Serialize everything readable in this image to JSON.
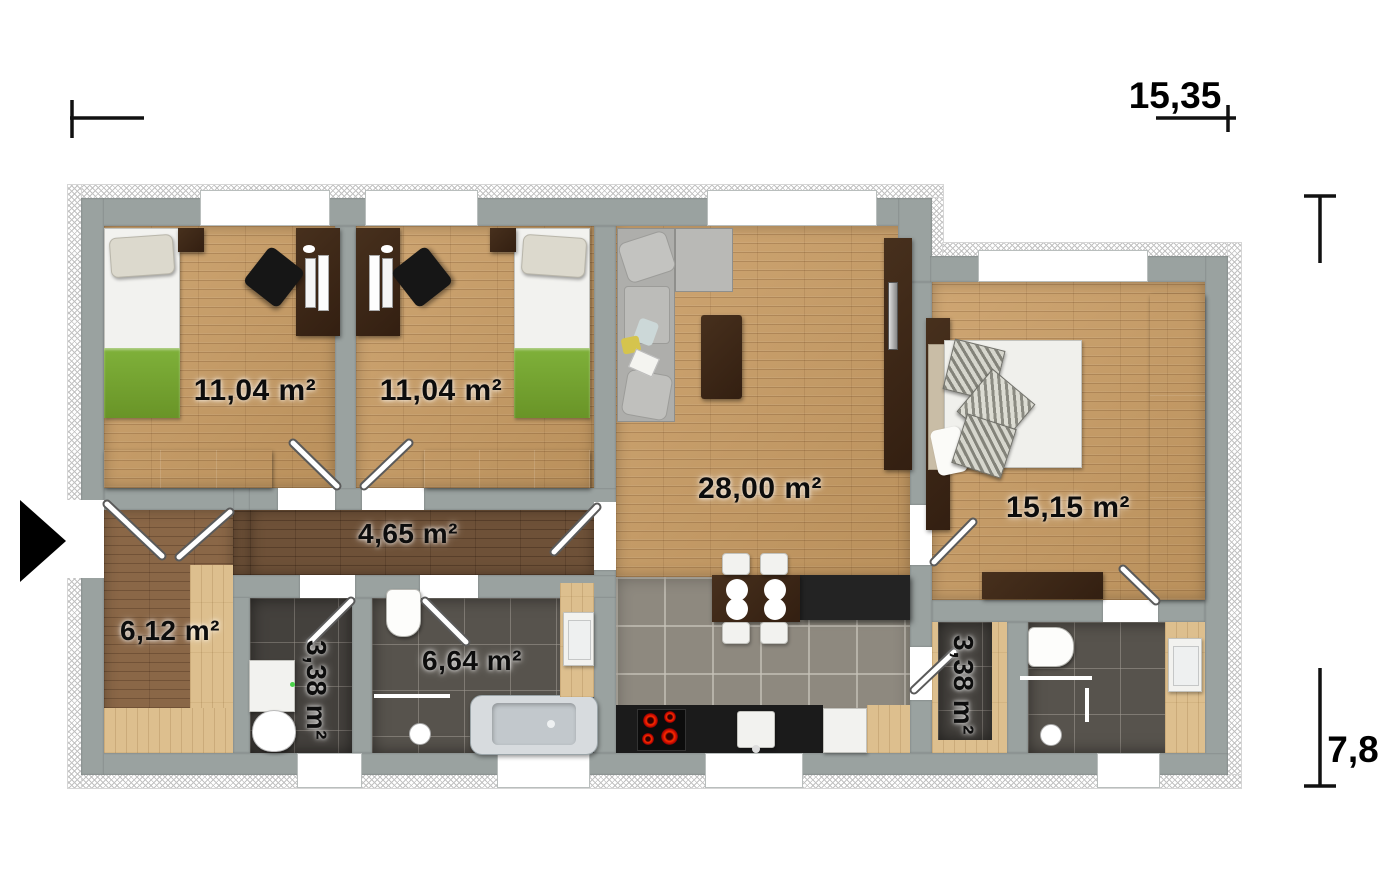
{
  "plan": {
    "type": "house-floor-plan",
    "dimension_labels": {
      "width": "15,35",
      "height": "7,8"
    },
    "rooms": [
      {
        "name": "bedroom-1",
        "area_label": "11,04 m²"
      },
      {
        "name": "bedroom-2",
        "area_label": "11,04 m²"
      },
      {
        "name": "living-room-kitchen",
        "area_label": "28,00 m²"
      },
      {
        "name": "bedroom-3",
        "area_label": "15,15 m²"
      },
      {
        "name": "hallway",
        "area_label": "4,65 m²"
      },
      {
        "name": "entry-hall",
        "area_label": "6,12 m²"
      },
      {
        "name": "wc-laundry",
        "area_label": "3,38 m²"
      },
      {
        "name": "bathroom",
        "area_label": "6,64 m²"
      },
      {
        "name": "utility-room",
        "area_label": "3,38 m²"
      }
    ],
    "colors": {
      "wall": "#9aa2a0",
      "wood_floor": "#c99c63",
      "dark_wood_floor": "#6e5138",
      "pale_wood": "#ddbf8e",
      "dark_tile": "#57534d",
      "kitchen_tile": "#8e897f",
      "furniture_dark_wood": "#3c2517",
      "bed_blanket_green": "#76a832",
      "cooktop_red": "#e02010",
      "background": "#ffffff"
    }
  }
}
